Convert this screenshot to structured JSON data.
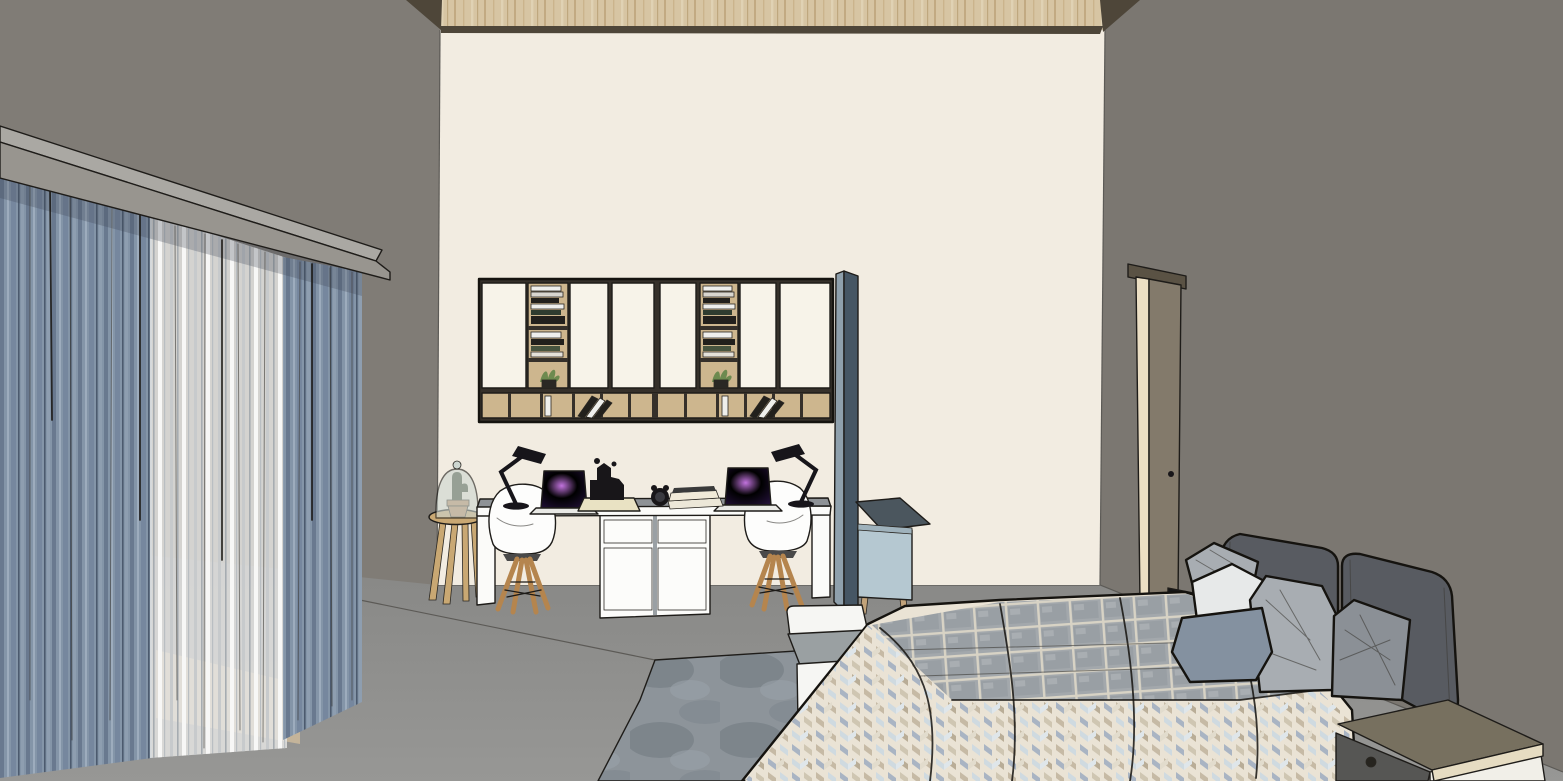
{
  "scene": {
    "kind": "3d-interior-render",
    "room": "bedroom-with-study-wall",
    "render_style": "sketchup-shaded-with-edges",
    "objects": {
      "curtain_panels": 3,
      "valance": 1,
      "wall_cabinet_doors": 6,
      "open_shelf_columns": 2,
      "shelf_plants": 2,
      "lower_cubby_row": 1,
      "desk": 1,
      "desk_drawer_units": 2,
      "chairs": 2,
      "desk_lamps": 2,
      "laptops": 2,
      "stool_with_cloche": 1,
      "divider_panel": 1,
      "blue_side_cabinet": 1,
      "door": 1,
      "book_stack_by_door": 1,
      "rug": 1,
      "bed_bench": 1,
      "bed": 1,
      "headboard_cushions": 2,
      "throw_pillows": 5,
      "nightstand": 1
    }
  },
  "palette": {
    "wall_left": "#807c76",
    "wall_right": "#7b7771",
    "wall_back": "#f2ece1",
    "floor_back": "#85observe",
    "floor_a": "#868684",
    "floor_b": "#979795",
    "ceiling_wood": "#d7c5a3",
    "ceiling_wood_line": "#c2aa82",
    "ceiling_trim": "#4e4639",
    "valance_top": "#aaa8a3",
    "valance_face": "#98958f",
    "drape_base": "#8495a8",
    "drape_dark": "#69798f",
    "drape_darker": "#4c5a6e",
    "drape_light": "#9dacbd",
    "sheer_base": "#e9e9e7",
    "sheer_fold": "#c7cacc",
    "sheer_dark": "#a6acb1",
    "baseboard": "#c4b49a",
    "unit_frame": "#35302a",
    "unit_door": "#f7f3e9",
    "unit_wood": "#cdb68e",
    "book_white": "#efefec",
    "book_dark": "#22201c",
    "plant_green": "#6d8a4f",
    "desk_white": "#fbfbf9",
    "desk_top": "#8e9296",
    "drawer_white": "#fcfcfa",
    "chair_white": "#fdfdfc",
    "chair_wood": "#b5854e",
    "lamp_black": "#17151a",
    "laptop_screen_hi": "#c273de",
    "laptop_screen_mid": "#6b389c2",
    "laptop_screen_lo": "#221038",
    "laptop_base": "#e9e9e5",
    "tray_cream": "#e9e2c3",
    "black_object": "#181619",
    "book_stack_cream": "#ece7d8",
    "panel_slate": "#465664",
    "panel_edge": "#8fa0ac",
    "cab_blue": "#b5c8d1",
    "cab_blue_top": "#4b565e",
    "leg_wood": "#c2a37a",
    "door_slab": "#837a6b",
    "door_frame": "#ecdfc4",
    "door_lintel": "#5a5244",
    "stool_wood": "#c9a873",
    "cloche_glass": "#cdd6d0",
    "cactus": "#3f4a36",
    "pot_clay": "#bc8e66",
    "rug_base": "#8d949a",
    "rug_dark": "#6e7880",
    "bench_white": "#f6f6f3",
    "bench_top": "#9aa0a2",
    "bed_cream": "#eae3d5",
    "quilt_gray": "#a3a8ac",
    "quilt_grout": "#d8d3c5",
    "chev_blue": "#a9b4c3",
    "chev_tan": "#c6baa5",
    "chev_light": "#cfdae0",
    "headboard": "#585b61",
    "pillow_white": "#e7e9e9",
    "pillow_gray": "#a8adb2",
    "pillow_slate": "#8491a0",
    "pillow_dark": "#8b9096",
    "nightstand_top": "#77705f",
    "nightstand_edge": "#e6dcc2",
    "nightstand_drawer": "#565654",
    "nightstand_white": "#f1efe8",
    "ledge_wood": "#c0a87f",
    "books_black": "#161616"
  }
}
